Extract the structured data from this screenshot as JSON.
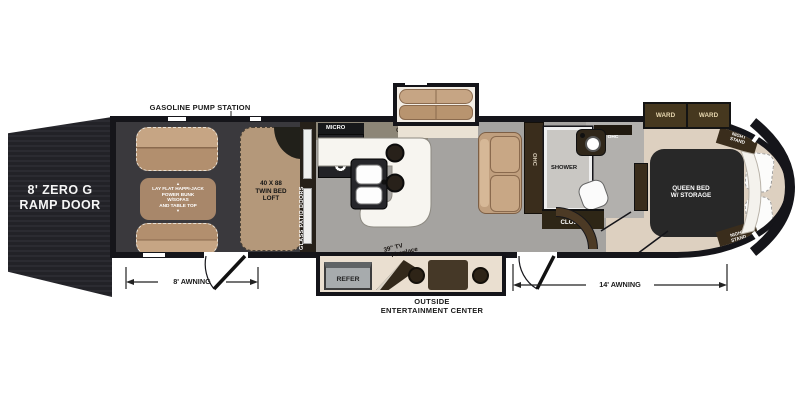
{
  "meta": {
    "type": "RV fifth-wheel toy hauler floor plan"
  },
  "palette": {
    "wall": "#15151a",
    "ramp": "#232328",
    "garage_floor": "#3a393d",
    "living_floor": "#a5a3a0",
    "bath_floor": "#b2b0ad",
    "bedroom_floor": "#ddd0c0",
    "slide_floor": "#eadfd0",
    "tan_furniture": "#b89979",
    "tan_light": "#c6a584",
    "bunk_tan": "#a8876a",
    "dark_brown": "#3a2d1c",
    "counter_white": "#f7f5f0",
    "bed_black": "#282828"
  },
  "labels": {
    "gas_station": "GASOLINE PUMP STATION",
    "ramp_l1": "8' ZERO G",
    "ramp_l2": "RAMP DOOR",
    "awning_rear": "8' AWNING",
    "awning_main": "14' AWNING",
    "outside_l1": "OUTSIDE",
    "outside_l2": "ENTERTAINMENT CENTER"
  },
  "garage": {
    "bunk_l1": "LAY FLAT HAPPI-JACK",
    "bunk_l2": "POWER BUNK",
    "bunk_l3": "W/SOFAS",
    "bunk_l4": "AND TABLE TOP",
    "loft_l1": "40 X 88",
    "loft_l2": "TWIN BED",
    "loft_l3": "LOFT",
    "patio_doors": "GLASS PATIO DOORS"
  },
  "icons": {
    "bunk_up_arrow": "▲",
    "bunk_down_arrow": "▼"
  },
  "kitchen": {
    "micro": "MICRO",
    "ohc": "OHC"
  },
  "living": {
    "ohc": "OHC"
  },
  "bath": {
    "shower": "SHOWER",
    "closet": "CLOSET",
    "ohc": "OHC",
    "tv": "TV"
  },
  "bedroom": {
    "ward_left": "WARD",
    "ward_right": "WARD",
    "ns_top_l1": "NIGHT",
    "ns_top_l2": "STAND",
    "ns_bot_l1": "NIGHT",
    "ns_bot_l2": "STAND",
    "bed_l1": "QUEEN BED",
    "bed_l2": "W/ STORAGE"
  },
  "entertainment": {
    "refer": "REFER",
    "fireplace_l1": "39\" TV",
    "fireplace_l2": "Fireplace"
  }
}
